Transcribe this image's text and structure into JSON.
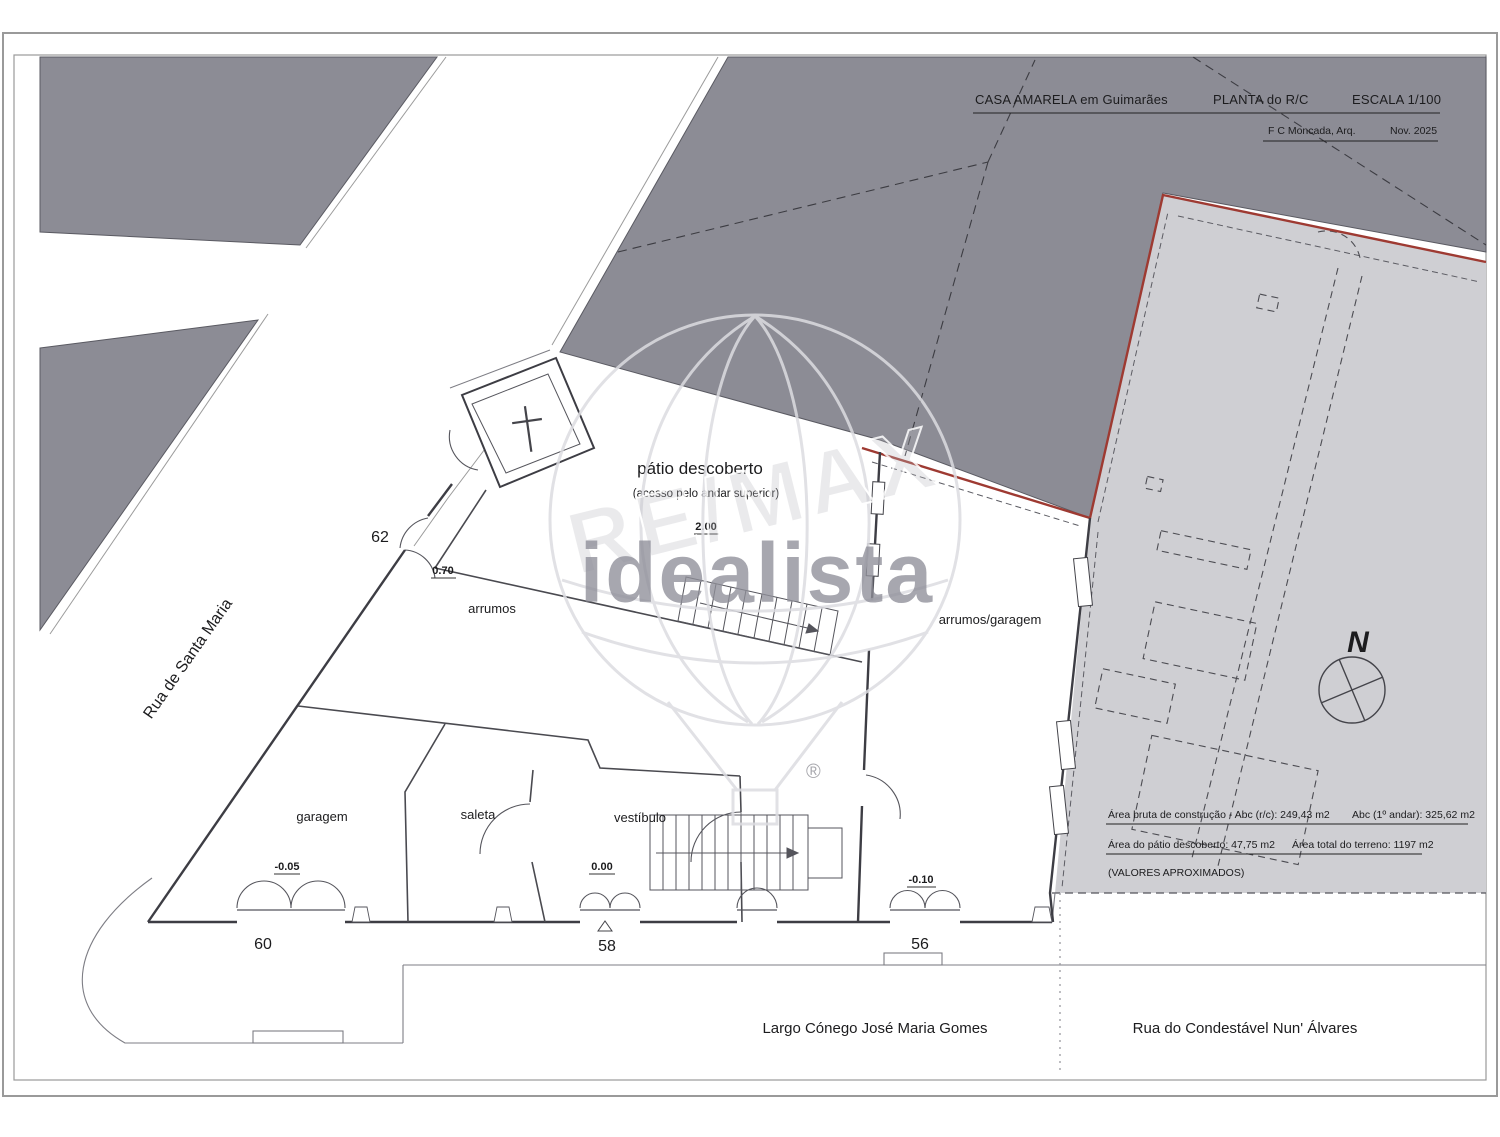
{
  "title_block": {
    "project": "CASA  AMARELA em Guimarães",
    "drawing": "PLANTA  do R/C",
    "scale": "ESCALA  1/100",
    "architect": "F C Moncada, Arq.",
    "date": "Nov. 2025"
  },
  "streets": {
    "santa_maria": "Rua de Santa Maria",
    "largo": "Largo Cónego José Maria Gomes",
    "condestavel": "Rua do Condestável Nun' Álvares"
  },
  "door_numbers": {
    "n62": "62",
    "n60": "60",
    "n58": "58",
    "n56": "56"
  },
  "rooms": {
    "patio": {
      "label": "pátio descoberto",
      "note": "(acesso pelo andar superior)",
      "level": "2.00"
    },
    "arrumos": {
      "label": "arrumos"
    },
    "arrumos_garagem": {
      "label": "arrumos/garagem",
      "level": "-0.10"
    },
    "garagem": {
      "label": "garagem",
      "level": "-0.05"
    },
    "saleta": {
      "label": "saleta"
    },
    "vestibulo": {
      "label": "vestíbulo",
      "level": "0.00"
    },
    "door62_level": "0.70"
  },
  "areas": {
    "line1a": "Área bruta de construção - Abc (r/c): 249,43 m2",
    "line1b": "Abc (1º andar): 325,62 m2",
    "line2a": "Área do pátio descoberto: 47,75 m2",
    "line2b": "Área total do terreno: 1197 m2",
    "note": "(VALORES APROXIMADOS)"
  },
  "compass": {
    "north": "N"
  },
  "watermark": {
    "brand": "RE/MAX",
    "portal": "idealista",
    "registered": "®"
  },
  "colors": {
    "block_dark": "#8c8c95",
    "terrain_light": "#cfcfd3",
    "boundary_red": "#9e3a32",
    "wall": "#3d3d44",
    "watermark_gray": "#8f8f99"
  }
}
